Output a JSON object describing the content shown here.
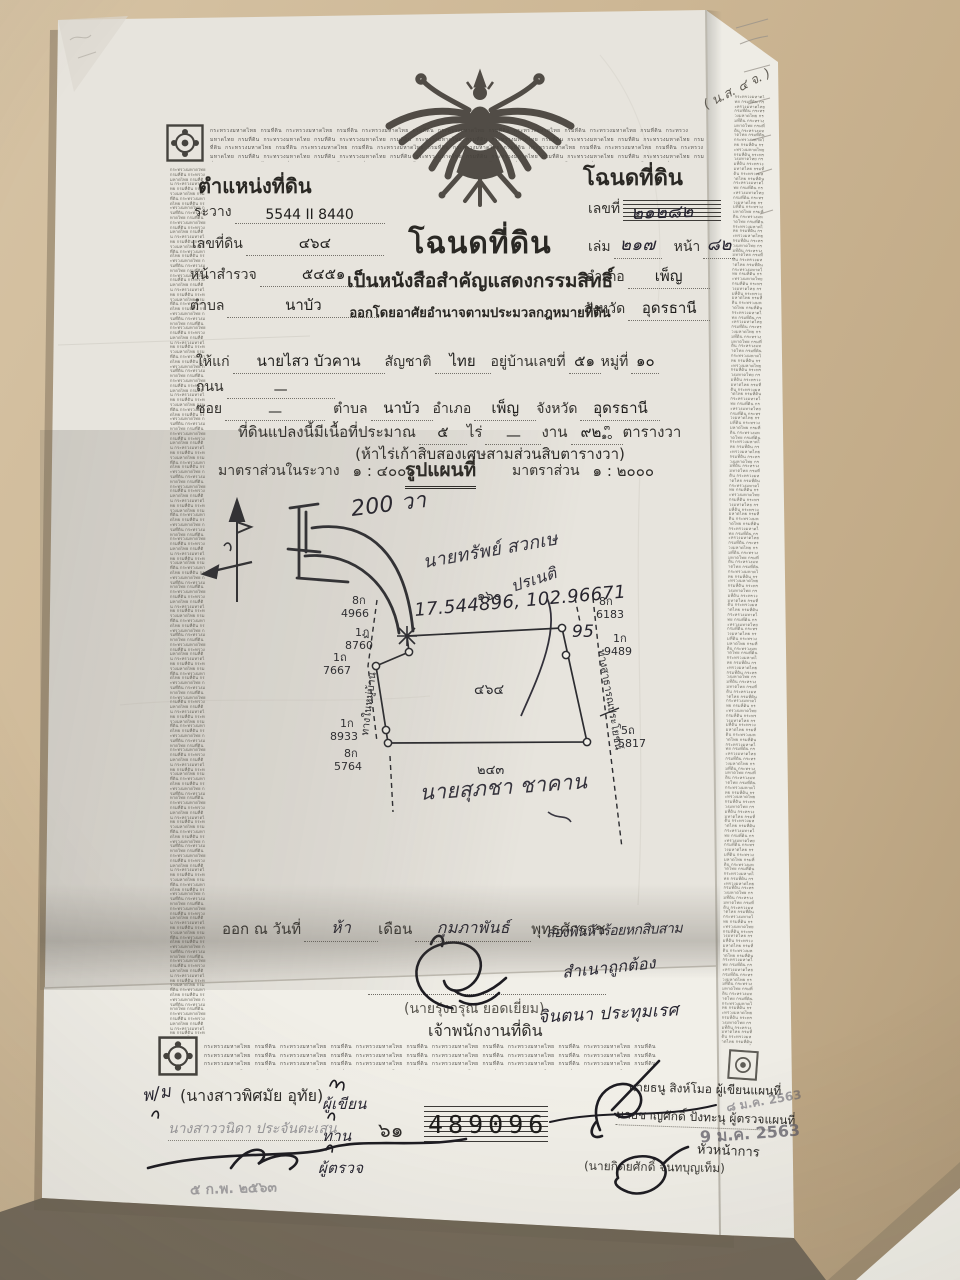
{
  "border": {
    "micro_text": "กระทรวงมหาดไทย กรมที่ดิน "
  },
  "corner_note": "( น.ส. ๔ จ. )",
  "position_block": {
    "title": "ตำแหน่งที่ดิน",
    "rows": [
      {
        "label": "ระวาง",
        "value": "5544 II 8440"
      },
      {
        "label": "เลขที่ดิน",
        "value": "๔๖๔"
      },
      {
        "label": "หน้าสำรวจ",
        "value": "๕๔๕๑"
      },
      {
        "label": "ตำบล",
        "value": "นาบัว"
      }
    ]
  },
  "deed_block": {
    "title": "โฉนดที่ดิน",
    "no_label": "เลขที่",
    "no_value": "๒๑๒๘๒",
    "volume_label": "เล่ม",
    "volume_value": "๒๑๗",
    "page_label": "หน้า",
    "page_value": "๘๒",
    "amphoe_label": "อำเภอ",
    "amphoe_value": "เพ็ญ",
    "province_label": "จังหวัด",
    "province_value": "อุดรธานี"
  },
  "title_block": {
    "main": "โฉนดที่ดิน",
    "sub1": "เป็นหนังสือสำคัญแสดงกรรมสิทธิ์",
    "sub2": "ออกโดยอาศัยอำนาจตามประมวลกฎหมายที่ดิน"
  },
  "grant": {
    "to_label": "ให้แก่",
    "to_value": "นายไสว  บัวคาน",
    "nationality_label": "สัญชาติ",
    "nationality_value": "ไทย",
    "address_label": "อยู่บ้านเลขที่",
    "address_value": "๕๑",
    "moo_label": "หมู่ที่",
    "moo_value": "๑๐",
    "road_label": "ถนน",
    "road_value": "—",
    "soi_label": "ซอย",
    "soi_value": "—",
    "tambon_label": "ตำบล",
    "tambon_value": "นาบัว",
    "amphoe_label": "อำเภอ",
    "amphoe_value": "เพ็ญ",
    "province_label": "จังหวัด",
    "province_value": "อุดรธานี",
    "area_label": "ที่ดินแปลงนี้มีเนื้อที่ประมาณ",
    "rai_value": "๕",
    "rai_label": "ไร่",
    "ngan_value": "—",
    "ngan_label": "งาน",
    "wa_value": "๙๒",
    "wa_frac_num": "๓",
    "wa_frac_den": "๑๐",
    "wa_label": "ตารางวา",
    "area_text": "(ห้าไร่เก้าสิบสองเศษสามส่วนสิบตารางวา)",
    "scale_left_label": "มาตราส่วนในระวาง",
    "scale_left_value": "๑ : ๔๐๐๐",
    "map_title": "รูปแผนที่",
    "scale_right_label": "มาตราส่วน",
    "scale_right_value": "๑ : ๒๐๐๐"
  },
  "map": {
    "handwritten_distance": "200 วา",
    "handwritten_name_top1": "นายทรัพย์  สวกเษ",
    "handwritten_name_top2": "ปรเนติ",
    "handwritten_coords": "17.544896, 102.96671",
    "handwritten_coords2": "95",
    "plot_number_top": "๑๖๐",
    "plot_number_center": "๔๖๔",
    "plot_number_bottom": "๒๔๓",
    "handwritten_name_bottom": "นายสุภชา  ชาคาน",
    "road_left": "ทางในหมู่บ้าน",
    "road_right": "ทางสาธารณประโยชน์",
    "markers": [
      {
        "code": "8ก",
        "num": "4966"
      },
      {
        "code": "1ฎ",
        "num": "8760"
      },
      {
        "code": "1ถ",
        "num": "7667"
      },
      {
        "code": "1ก",
        "num": "8933"
      },
      {
        "code": "8ก",
        "num": "5764"
      },
      {
        "code": "8ก",
        "num": "6183"
      },
      {
        "code": "1ก",
        "num": "9489"
      },
      {
        "code": "5ถ",
        "num": "5817"
      }
    ]
  },
  "issue": {
    "prefix": "ออก ณ วันที่",
    "day": "ห้า",
    "month_label": "เดือน",
    "month": "กุมภาพันธ์",
    "era_label": "พุทธศักราช",
    "year": "สองพันห้าร้อยหกสิบสาม",
    "officer_name": "(นายรุ่งอรุณ  ยอดเยี่ยม)",
    "officer_title": "เจ้าพนักงานที่ดิน",
    "certify_text": "สำเนาถูกต้อง",
    "certify_name": "จินตนา  ประทุมเรศ"
  },
  "footer": {
    "writer_initial": "พ/ม",
    "writer_name": "(นางสาวพิศมัย  อุทัย)",
    "writer_role": "ผู้เขียน",
    "checker_name": "นางสาววนิดา ประจันตะเสน",
    "checker_role": "ทาน",
    "inspector_role": "ผู้ตรวจ",
    "date_stamp": "๕ ก.พ. ๒๕๖๓",
    "book_no": "๖๑",
    "serial": "489096",
    "map_writer": "นายธนู  สิงห์โมอ  ผู้เขียนแผนที่",
    "map_checker": "นายชาญศักดิ์  ปังทะนุ  ผู้ตรวจแผนที่",
    "stamp_date1": "๘ ม.ค. 2563",
    "stamp_date2": "9 ม.ค. 2563",
    "chief_name": "(นายกิตยศักดิ์  จันทบุญเท็ม)",
    "chief_role": "หัวหน้าการ"
  }
}
